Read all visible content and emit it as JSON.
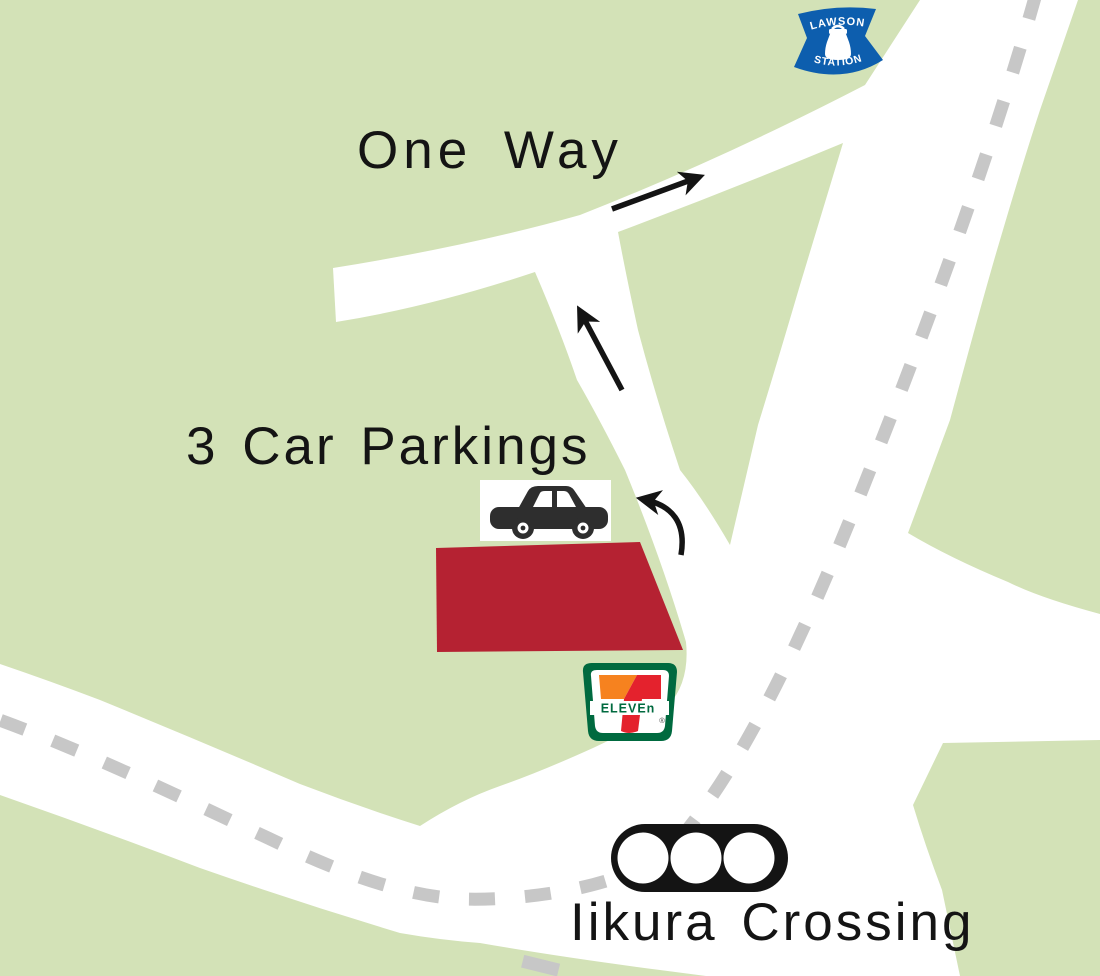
{
  "map": {
    "title_labels": {
      "one_way": "One Way",
      "car_parkings": "3 Car Parkings",
      "crossing": "Iikura Crossing"
    },
    "logos": {
      "lawson_top": "LAWSON",
      "lawson_bottom": "STATION",
      "seven_eleven": "ELEVEn",
      "seven_eleven_registered": "®"
    },
    "colors": {
      "land_green": "#d3e2b7",
      "road_white": "#ffffff",
      "dash_gray": "#c7c7c7",
      "parking_red": "#b52232",
      "lawson_blue": "#0d5eae",
      "seven_green": "#006a3f",
      "seven_orange": "#f6821f",
      "seven_red": "#e4222d",
      "ink_black": "#141414"
    }
  }
}
